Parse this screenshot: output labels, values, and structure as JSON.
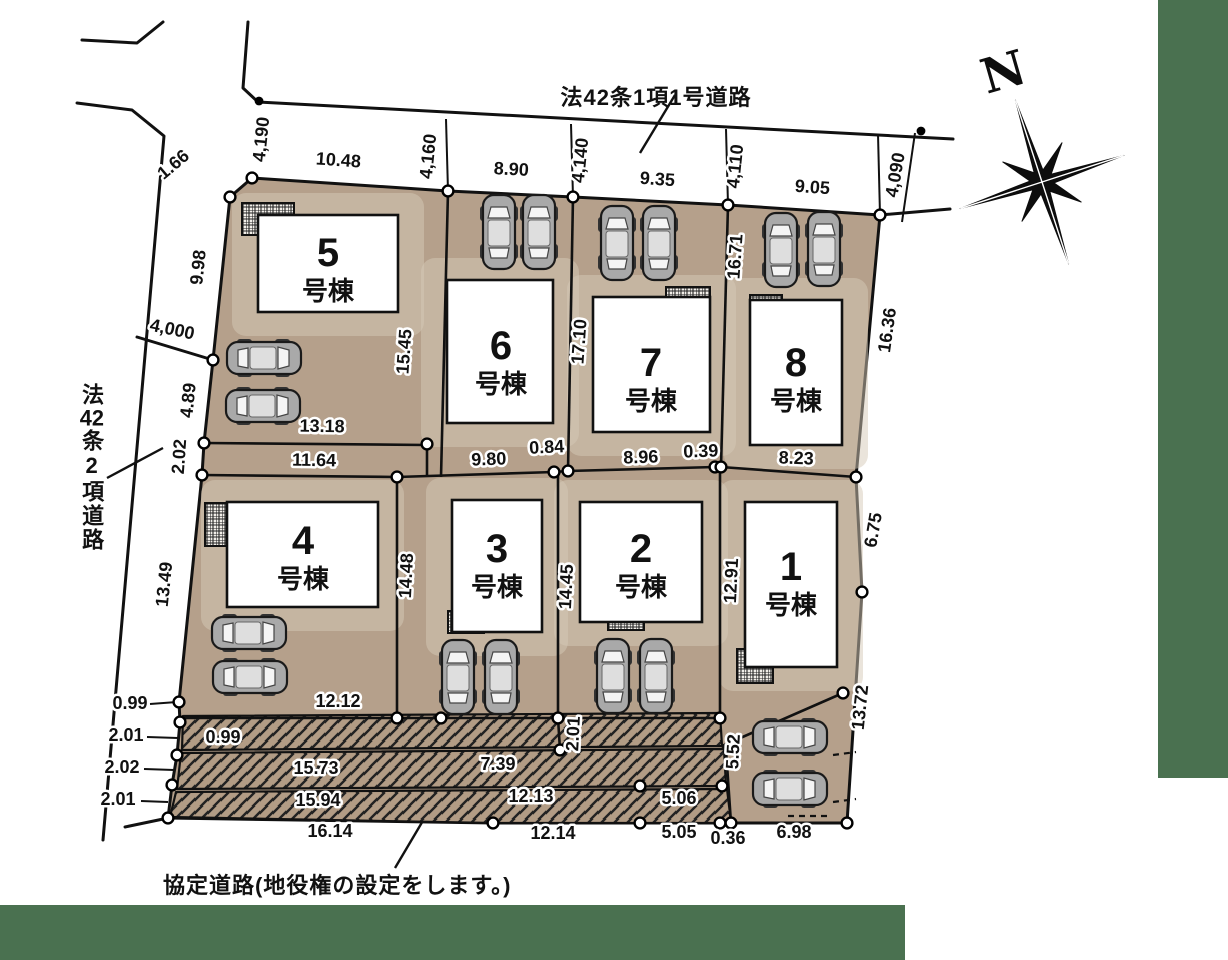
{
  "canvas": {
    "width": 1228,
    "height": 960,
    "bg": "#ffffff",
    "green": "#4a7150",
    "land": "#b5a08b",
    "land_light": "#d6c9b7",
    "hatch_fill": "#b29c85",
    "line": "#1a1a1a"
  },
  "compass": {
    "label": "N"
  },
  "roads": {
    "north": {
      "label": "法42条1項1号道路"
    },
    "west": {
      "label_pre": "法",
      "label_num": "42",
      "label_post": "条2項道路"
    },
    "agreement_note": "協定道路(地役権の設定をします。)"
  },
  "lots": [
    {
      "number": "5",
      "suffix": "号棟",
      "bldg": [
        258,
        215,
        140,
        97
      ],
      "label_xy": [
        328,
        252
      ]
    },
    {
      "number": "6",
      "suffix": "号棟",
      "bldg": [
        447,
        280,
        106,
        143
      ],
      "label_xy": [
        501,
        345
      ]
    },
    {
      "number": "7",
      "suffix": "号棟",
      "bldg": [
        593,
        297,
        117,
        135
      ],
      "label_xy": [
        651,
        362
      ]
    },
    {
      "number": "8",
      "suffix": "号棟",
      "bldg": [
        750,
        300,
        92,
        145
      ],
      "label_xy": [
        796,
        362
      ]
    },
    {
      "number": "4",
      "suffix": "号棟",
      "bldg": [
        227,
        502,
        151,
        105
      ],
      "label_xy": [
        303,
        540
      ]
    },
    {
      "number": "3",
      "suffix": "号棟",
      "bldg": [
        452,
        500,
        90,
        132
      ],
      "label_xy": [
        497,
        548
      ]
    },
    {
      "number": "2",
      "suffix": "号棟",
      "bldg": [
        580,
        502,
        122,
        120
      ],
      "label_xy": [
        641,
        548
      ]
    },
    {
      "number": "1",
      "suffix": "号棟",
      "bldg": [
        745,
        502,
        92,
        165
      ],
      "label_xy": [
        791,
        566
      ]
    }
  ],
  "porches": [
    [
      242,
      203,
      52,
      32
    ],
    [
      447,
      280,
      32,
      24
    ],
    [
      666,
      287,
      44,
      25
    ],
    [
      750,
      295,
      32,
      23
    ],
    [
      205,
      503,
      40,
      43
    ],
    [
      448,
      611,
      36,
      22
    ],
    [
      608,
      604,
      36,
      26
    ],
    [
      737,
      649,
      36,
      34
    ]
  ],
  "cars": [
    {
      "x": 499,
      "y": 232,
      "r": 0
    },
    {
      "x": 539,
      "y": 232,
      "r": 0
    },
    {
      "x": 617,
      "y": 243,
      "r": 0
    },
    {
      "x": 659,
      "y": 243,
      "r": 0
    },
    {
      "x": 781,
      "y": 250,
      "r": 0
    },
    {
      "x": 824,
      "y": 249,
      "r": 0
    },
    {
      "x": 264,
      "y": 358,
      "r": 90
    },
    {
      "x": 263,
      "y": 406,
      "r": 90
    },
    {
      "x": 249,
      "y": 633,
      "r": 90
    },
    {
      "x": 250,
      "y": 677,
      "r": 90
    },
    {
      "x": 458,
      "y": 677,
      "r": 0
    },
    {
      "x": 501,
      "y": 677,
      "r": 0
    },
    {
      "x": 613,
      "y": 676,
      "r": 0
    },
    {
      "x": 656,
      "y": 676,
      "r": 0
    },
    {
      "x": 790,
      "y": 737,
      "r": 90
    },
    {
      "x": 790,
      "y": 789,
      "r": 90
    }
  ],
  "survey_points": [
    [
      252,
      178
    ],
    [
      230,
      197
    ],
    [
      448,
      191
    ],
    [
      573,
      197
    ],
    [
      728,
      205
    ],
    [
      880,
      215
    ],
    [
      213,
      360
    ],
    [
      204,
      443
    ],
    [
      202,
      475
    ],
    [
      427,
      444
    ],
    [
      397,
      477
    ],
    [
      554,
      472
    ],
    [
      568,
      471
    ],
    [
      715,
      467
    ],
    [
      721,
      467
    ],
    [
      856,
      477
    ],
    [
      862,
      592
    ],
    [
      179,
      702
    ],
    [
      180,
      722
    ],
    [
      177,
      755
    ],
    [
      172,
      785
    ],
    [
      168,
      818
    ],
    [
      397,
      718
    ],
    [
      441,
      718
    ],
    [
      558,
      718
    ],
    [
      560,
      750
    ],
    [
      720,
      718
    ],
    [
      843,
      693
    ],
    [
      640,
      786
    ],
    [
      722,
      786
    ],
    [
      493,
      823
    ],
    [
      640,
      823
    ],
    [
      720,
      823
    ],
    [
      731,
      823
    ],
    [
      847,
      823
    ]
  ],
  "marker_points": [
    [
      259,
      101
    ],
    [
      921,
      131
    ]
  ],
  "dimensions": [
    {
      "t": "1.66",
      "x": 177,
      "y": 169,
      "r": -40
    },
    {
      "t": "4,190",
      "x": 267,
      "y": 140,
      "r": -84
    },
    {
      "t": "10.48",
      "x": 338,
      "y": 166,
      "r": 4
    },
    {
      "t": "4,160",
      "x": 434,
      "y": 157,
      "r": -84
    },
    {
      "t": "8.90",
      "x": 511,
      "y": 175,
      "r": 3
    },
    {
      "t": "4,140",
      "x": 586,
      "y": 161,
      "r": -84
    },
    {
      "t": "9.35",
      "x": 657,
      "y": 185,
      "r": 4
    },
    {
      "t": "4,110",
      "x": 741,
      "y": 167,
      "r": -84
    },
    {
      "t": "9.05",
      "x": 812,
      "y": 193,
      "r": 4
    },
    {
      "t": "4,090",
      "x": 901,
      "y": 176,
      "r": -80
    },
    {
      "t": "9.98",
      "x": 204,
      "y": 268,
      "r": -84
    },
    {
      "t": "4,000",
      "x": 171,
      "y": 335,
      "r": 12
    },
    {
      "t": "4.89",
      "x": 194,
      "y": 401,
      "r": -84
    },
    {
      "t": "2.02",
      "x": 185,
      "y": 457,
      "r": -86
    },
    {
      "t": "13.49",
      "x": 170,
      "y": 585,
      "r": -84
    },
    {
      "t": "0.99",
      "x": 130,
      "y": 709,
      "r": 0
    },
    {
      "t": "2.01",
      "x": 126,
      "y": 741,
      "r": 0
    },
    {
      "t": "2.02",
      "x": 122,
      "y": 773,
      "r": 0
    },
    {
      "t": "2.01",
      "x": 118,
      "y": 805,
      "r": 0
    },
    {
      "t": "13.18",
      "x": 322,
      "y": 432,
      "r": 1
    },
    {
      "t": "11.64",
      "x": 314,
      "y": 466,
      "r": 1
    },
    {
      "t": "15.45",
      "x": 410,
      "y": 352,
      "r": -86
    },
    {
      "t": "9.80",
      "x": 489,
      "y": 465,
      "r": -2
    },
    {
      "t": "0.84",
      "x": 547,
      "y": 453,
      "r": -3
    },
    {
      "t": "17.10",
      "x": 585,
      "y": 342,
      "r": -86
    },
    {
      "t": "8.96",
      "x": 641,
      "y": 463,
      "r": -2
    },
    {
      "t": "0.39",
      "x": 701,
      "y": 457,
      "r": -2
    },
    {
      "t": "16.71",
      "x": 741,
      "y": 257,
      "r": -86
    },
    {
      "t": "8.23",
      "x": 796,
      "y": 464,
      "r": 2
    },
    {
      "t": "16.36",
      "x": 893,
      "y": 331,
      "r": -82
    },
    {
      "t": "6.75",
      "x": 879,
      "y": 531,
      "r": -80
    },
    {
      "t": "12.91",
      "x": 737,
      "y": 581,
      "r": -87
    },
    {
      "t": "14.45",
      "x": 572,
      "y": 587,
      "r": -87
    },
    {
      "t": "14.48",
      "x": 412,
      "y": 576,
      "r": -87
    },
    {
      "t": "12.12",
      "x": 338,
      "y": 707,
      "r": 0
    },
    {
      "t": "0.99",
      "x": 223,
      "y": 743,
      "r": 0
    },
    {
      "t": "2.01",
      "x": 579,
      "y": 734,
      "r": -87
    },
    {
      "t": "5.52",
      "x": 739,
      "y": 752,
      "r": -87
    },
    {
      "t": "15.73",
      "x": 316,
      "y": 774,
      "r": 0
    },
    {
      "t": "7.39",
      "x": 498,
      "y": 770,
      "r": 0
    },
    {
      "t": "15.94",
      "x": 318,
      "y": 806,
      "r": 0
    },
    {
      "t": "12.13",
      "x": 531,
      "y": 802,
      "r": 0
    },
    {
      "t": "5.06",
      "x": 679,
      "y": 804,
      "r": 0
    },
    {
      "t": "16.14",
      "x": 330,
      "y": 837,
      "r": 0
    },
    {
      "t": "12.14",
      "x": 553,
      "y": 839,
      "r": 0
    },
    {
      "t": "5.05",
      "x": 679,
      "y": 838,
      "r": 0
    },
    {
      "t": "0.36",
      "x": 728,
      "y": 844,
      "r": 0
    },
    {
      "t": "6.98",
      "x": 794,
      "y": 838,
      "r": 0
    },
    {
      "t": "13.72",
      "x": 866,
      "y": 708,
      "r": -84
    }
  ]
}
